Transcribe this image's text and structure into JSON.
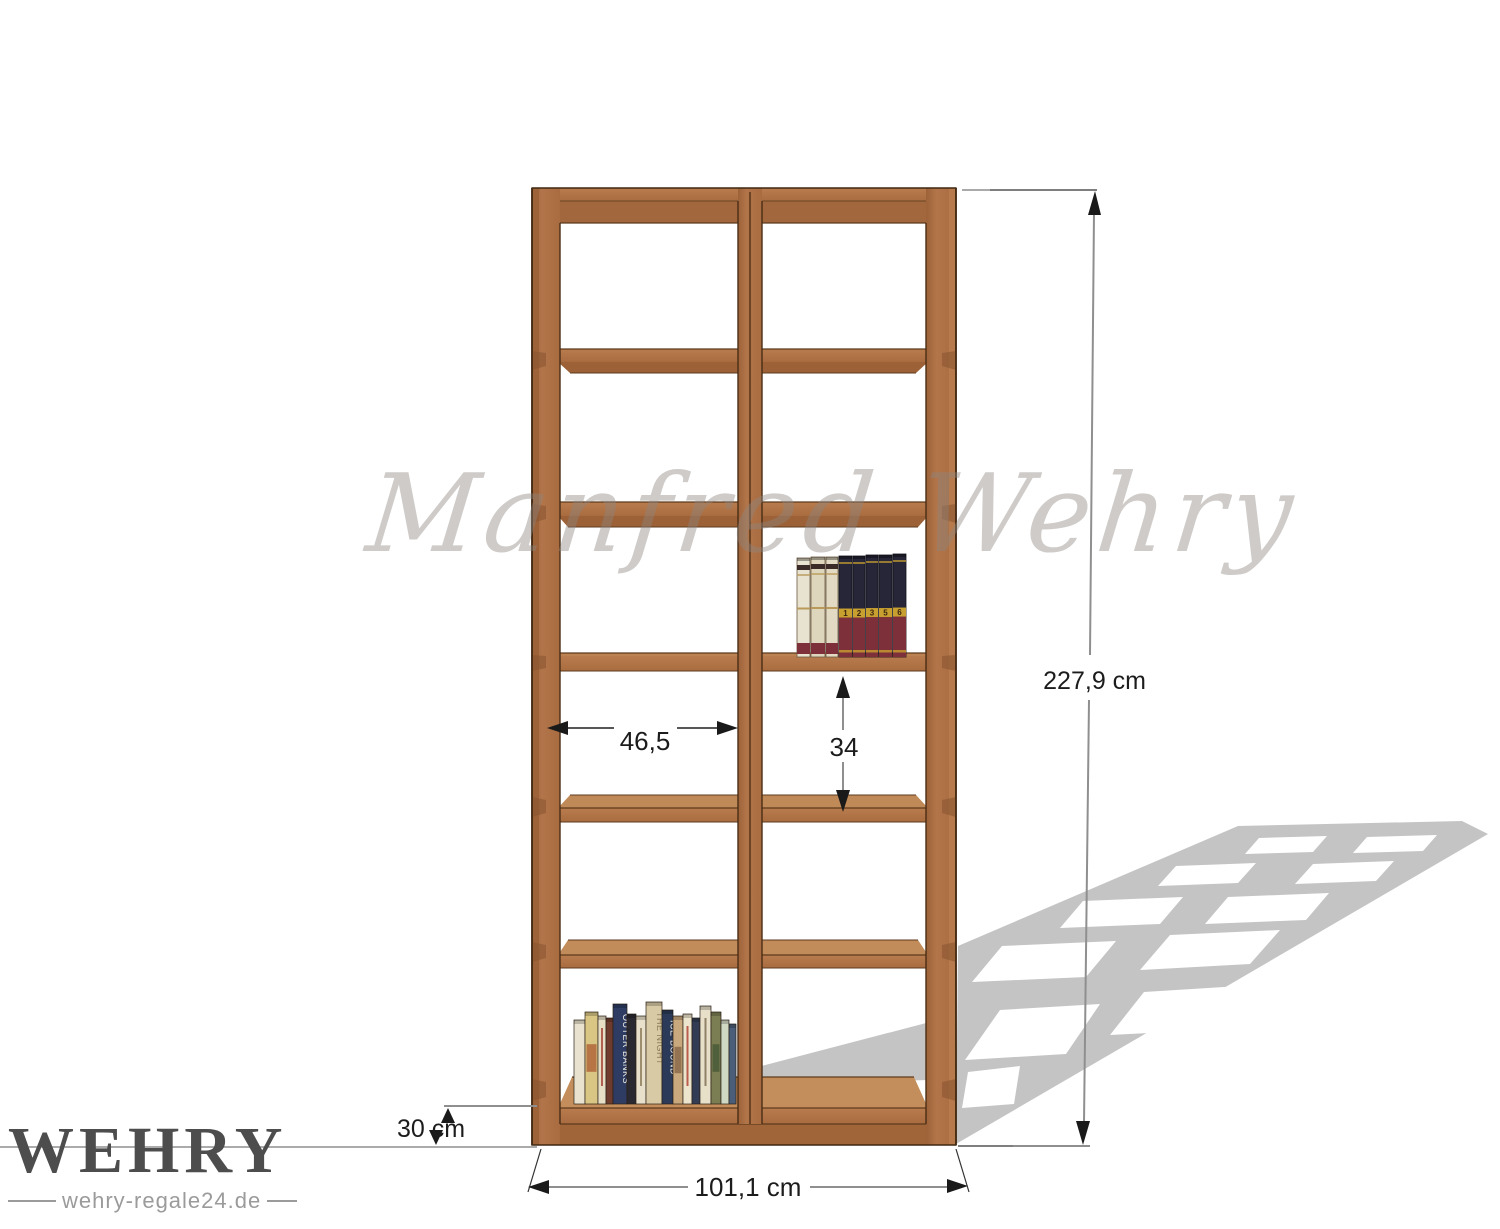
{
  "watermark": {
    "text": "Manfred Wehry"
  },
  "branding": {
    "name": "WEHRY",
    "website": "wehry-regale24.de"
  },
  "dimensions": {
    "total_height": "227,9 cm",
    "total_width": "101,1 cm",
    "depth": "30 cm",
    "compartment_width": "46,5",
    "compartment_height": "34"
  },
  "shelf": {
    "columns": 2,
    "rows": 6,
    "wood_color": "#b2744a",
    "wood_dark": "#9c6136",
    "wood_light": "#c28c5a",
    "outline_color": "#4a2d15"
  },
  "decor": {
    "shadow_color": "#c4c4c4",
    "books_left": [
      {
        "w": 11,
        "h": 84,
        "c": "#e9e2cf"
      },
      {
        "w": 13,
        "h": 92,
        "c": "#d9c584",
        "art": "#b0653a"
      },
      {
        "w": 8,
        "h": 88,
        "c": "#e7dec6",
        "t": "#a33f33"
      },
      {
        "w": 7,
        "h": 86,
        "c": "#6e3b2c"
      },
      {
        "w": 14,
        "h": 100,
        "c": "#2e3c64",
        "label": "OUTER BANKS",
        "lc": "#f2f0e8"
      },
      {
        "w": 9,
        "h": 90,
        "c": "#2a2830"
      },
      {
        "w": 10,
        "h": 88,
        "c": "#e8e0ca",
        "t": "#8a7a55"
      },
      {
        "w": 16,
        "h": 102,
        "c": "#d9caa6",
        "label": "THE NIGHT",
        "lc": "#8a7a55"
      },
      {
        "w": 11,
        "h": 94,
        "c": "#2b3a58",
        "label": "ICE-BOUND",
        "lc": "#f2f0e8"
      },
      {
        "w": 10,
        "h": 88,
        "c": "#c8a87c",
        "art": "#8a6a4a"
      },
      {
        "w": 9,
        "h": 90,
        "c": "#ece4cc",
        "t": "#b03a30"
      },
      {
        "w": 8,
        "h": 86,
        "c": "#323c54"
      },
      {
        "w": 11,
        "h": 98,
        "c": "#e7dfc8",
        "t": "#7a6a50"
      },
      {
        "w": 10,
        "h": 92,
        "c": "#7b7e53",
        "art": "#4a5a38"
      },
      {
        "w": 8,
        "h": 84,
        "c": "#cfd8c2"
      },
      {
        "w": 7,
        "h": 80,
        "c": "#4a5e7a"
      }
    ],
    "books_right": [
      {
        "w": 13,
        "h": 99,
        "style": "cream",
        "c": "#e8e2d0"
      },
      {
        "w": 14,
        "h": 100,
        "style": "cream",
        "c": "#ded5bd"
      },
      {
        "w": 12,
        "h": 100,
        "style": "cream",
        "c": "#e3dac4"
      },
      {
        "w": 13,
        "h": 101,
        "style": "dark",
        "num": "1"
      },
      {
        "w": 12,
        "h": 101,
        "style": "dark",
        "num": "2"
      },
      {
        "w": 12,
        "h": 102,
        "style": "dark",
        "num": "3"
      },
      {
        "w": 13,
        "h": 102,
        "style": "dark",
        "num": "5"
      },
      {
        "w": 13,
        "h": 103,
        "style": "dark",
        "num": "6"
      }
    ]
  }
}
